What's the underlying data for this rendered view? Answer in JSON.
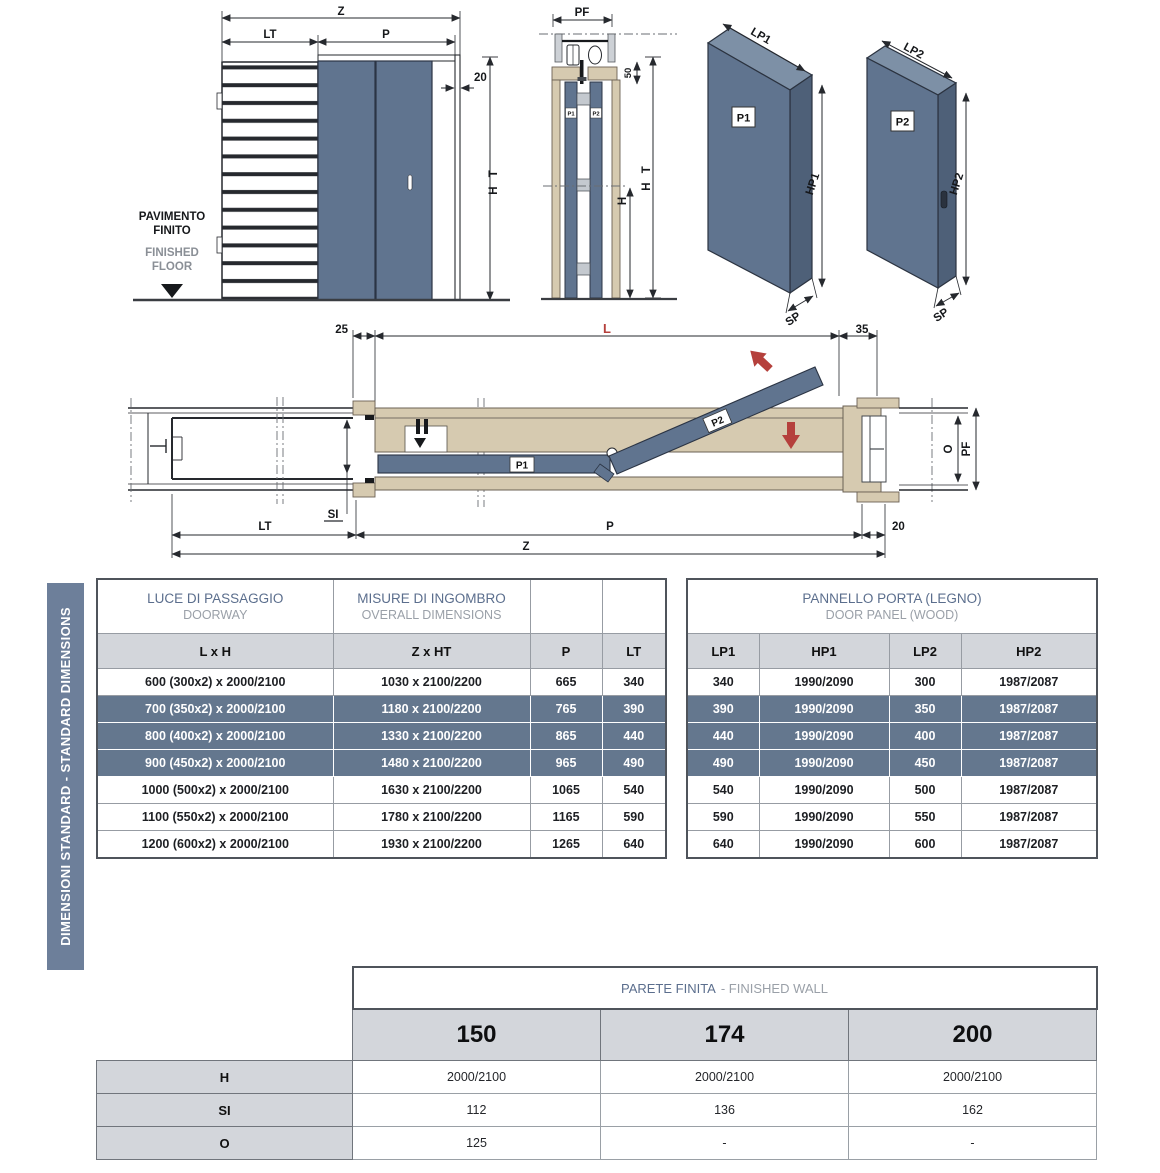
{
  "colors": {
    "panel_blue": "#60748f",
    "panel_blue_dark": "#4e6078",
    "panel_blue_light": "#7d90a6",
    "wood_beige": "#d6cab0",
    "wood_outline": "#6b6154",
    "highlight_row_blue": "#64778e",
    "header_grey": "#d3d6db",
    "sidebar_blue": "#6d7f9a",
    "accent_red": "#b5403c",
    "title_blue": "#5b6e8d",
    "subtitle_grey": "#9aa0a8"
  },
  "sidebar": {
    "label": "DIMENSIONI STANDARD - STANDARD DIMENSIONS"
  },
  "drawings": {
    "front_elevation": {
      "dim_z": "Z",
      "dim_lt": "LT",
      "dim_p": "P",
      "dim_20": "20",
      "dim_ht": "H T",
      "floor_it_line1": "PAVIMENTO",
      "floor_it_line2": "FINITO",
      "floor_en_line1": "FINISHED",
      "floor_en_line2": "FLOOR"
    },
    "section_view": {
      "dim_pf": "PF",
      "dim_50": "50",
      "dim_h": "H",
      "dim_ht": "H T",
      "panel1": "P1",
      "panel2": "P2"
    },
    "panel_p1": {
      "label": "P1",
      "dim_width": "LP1",
      "dim_height": "HP1",
      "dim_thickness": "SP"
    },
    "panel_p2": {
      "label": "P2",
      "dim_width": "LP2",
      "dim_height": "HP2",
      "dim_thickness": "SP"
    },
    "plan_view": {
      "dim_25": "25",
      "dim_l": "L",
      "dim_35": "35",
      "dim_si": "SI",
      "dim_lt": "LT",
      "dim_p": "P",
      "dim_20": "20",
      "dim_z": "Z",
      "dim_o": "O",
      "dim_pf": "PF",
      "panel1": "P1",
      "panel2": "P2"
    }
  },
  "doorway_table": {
    "title_it": "LUCE DI PASSAGGIO",
    "title_en": "DOORWAY",
    "title2_it": "MISURE DI INGOMBRO",
    "title2_en": "OVERALL DIMENSIONS",
    "columns": [
      "L x H",
      "Z x HT",
      "P",
      "LT"
    ],
    "rows": [
      [
        "600 (300x2) x 2000/2100",
        "1030 x 2100/2200",
        "665",
        "340"
      ],
      [
        "700 (350x2) x 2000/2100",
        "1180 x 2100/2200",
        "765",
        "390"
      ],
      [
        "800 (400x2) x 2000/2100",
        "1330 x 2100/2200",
        "865",
        "440"
      ],
      [
        "900 (450x2) x 2000/2100",
        "1480 x 2100/2200",
        "965",
        "490"
      ],
      [
        "1000 (500x2) x 2000/2100",
        "1630 x 2100/2200",
        "1065",
        "540"
      ],
      [
        "1100 (550x2) x 2000/2100",
        "1780 x 2100/2200",
        "1165",
        "590"
      ],
      [
        "1200 (600x2) x 2000/2100",
        "1930 x 2100/2200",
        "1265",
        "640"
      ]
    ]
  },
  "door_panel_table": {
    "title_it": "PANNELLO PORTA (LEGNO)",
    "title_en": "DOOR PANEL (WOOD)",
    "columns": [
      "LP1",
      "HP1",
      "LP2",
      "HP2"
    ],
    "rows": [
      [
        "340",
        "1990/2090",
        "300",
        "1987/2087"
      ],
      [
        "390",
        "1990/2090",
        "350",
        "1987/2087"
      ],
      [
        "440",
        "1990/2090",
        "400",
        "1987/2087"
      ],
      [
        "490",
        "1990/2090",
        "450",
        "1987/2087"
      ],
      [
        "540",
        "1990/2090",
        "500",
        "1987/2087"
      ],
      [
        "590",
        "1990/2090",
        "550",
        "1987/2087"
      ],
      [
        "640",
        "1990/2090",
        "600",
        "1987/2087"
      ]
    ]
  },
  "finished_wall_table": {
    "title_it": "PARETE FINITA",
    "title_en": "- FINISHED WALL",
    "columns": [
      "150",
      "174",
      "200"
    ],
    "row_labels": [
      "H",
      "SI",
      "O"
    ],
    "rows": [
      [
        "2000/2100",
        "2000/2100",
        "2000/2100"
      ],
      [
        "112",
        "136",
        "162"
      ],
      [
        "125",
        "-",
        "-"
      ]
    ]
  }
}
